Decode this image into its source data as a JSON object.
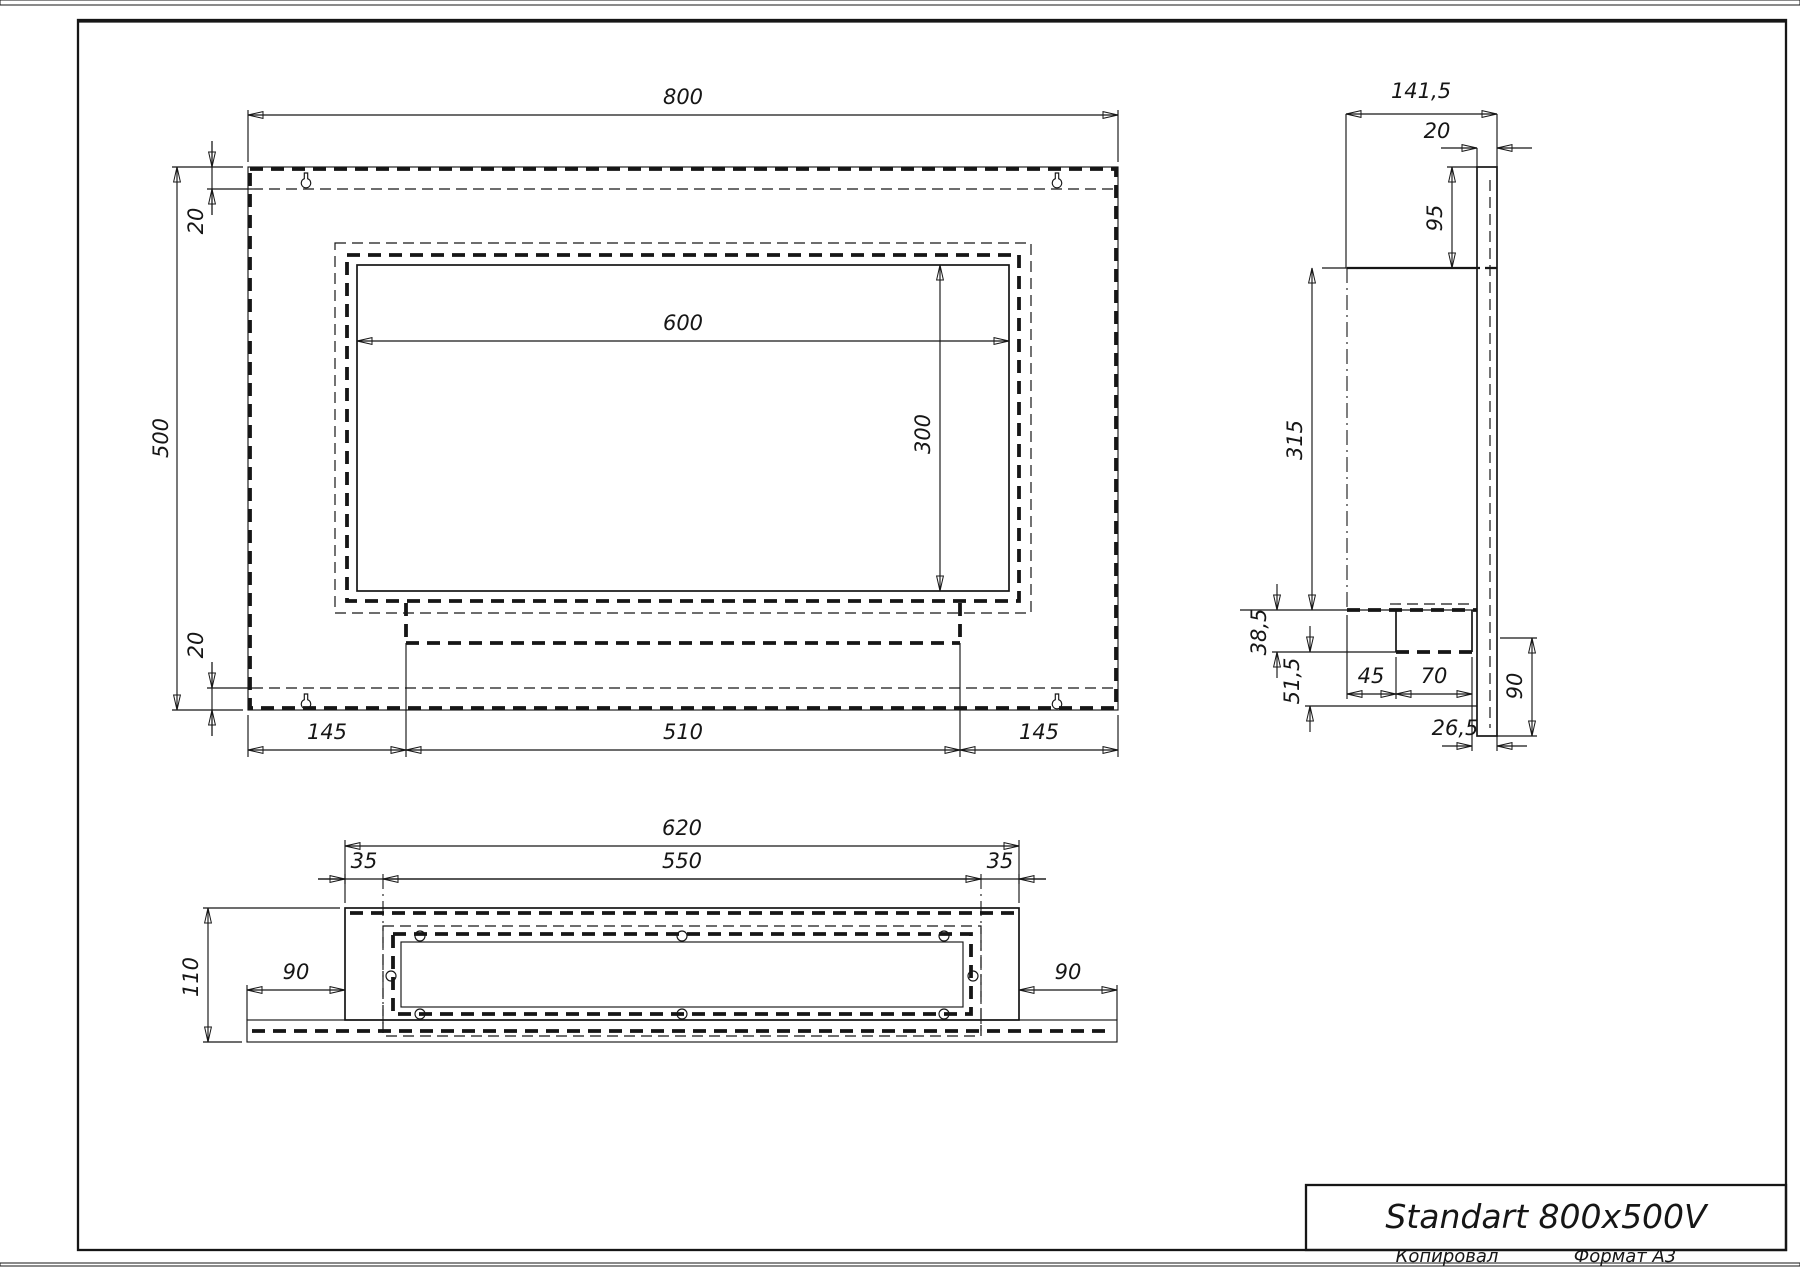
{
  "page": {
    "background": "#ffffff",
    "line_color": "#161616",
    "bottom_bar_color": "#7e7e7e"
  },
  "title_block": {
    "title": "Standart 800x500V",
    "copied": "Копировал",
    "format": "Формат А3"
  },
  "views": {
    "front": {
      "label": "front-view",
      "dims": {
        "width": "800",
        "height": "500",
        "inset_top": "20",
        "inset_bottom": "20",
        "opening_width": "600",
        "opening_height": "300",
        "margin_left": "145",
        "burner_width": "510",
        "margin_right": "145"
      }
    },
    "side": {
      "label": "side-view",
      "dims": {
        "depth": "141,5",
        "plate_thickness": "20",
        "top_drop": "95",
        "body_height": "315",
        "tray_height": "38,5",
        "lower_gap": "51,5",
        "tray_offset": "45",
        "tray_width": "70",
        "back_gap": "26,5",
        "plate_drop": "90"
      }
    },
    "bottom": {
      "label": "bottom-view",
      "dims": {
        "outer_width": "620",
        "inner_width": "550",
        "inset_left": "35",
        "inset_right": "35",
        "depth": "110",
        "margin_left": "90",
        "margin_right": "90"
      }
    }
  }
}
